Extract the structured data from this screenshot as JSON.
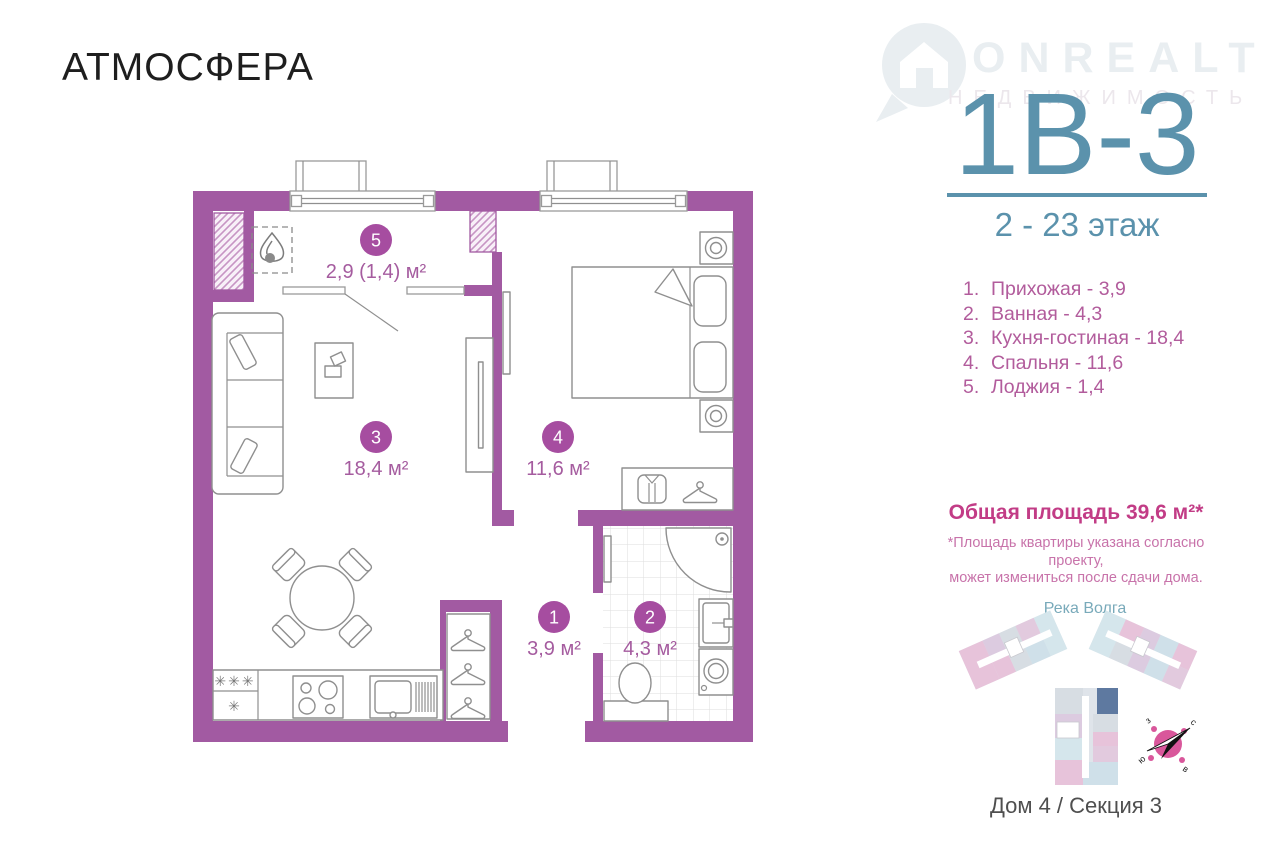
{
  "theme": {
    "wall_purple": "#a25aa2",
    "room_circle": "#a64da0",
    "plan_label": "#a55c9f",
    "accent_teal": "#5b92ac",
    "accent_teal_light": "#79aaba",
    "list_pink": "#b25c9c",
    "total_pink": "#c23c86",
    "note_pink": "#c873aa",
    "furniture_gray": "#8f8f8f",
    "logo_black": "#1e1e1e",
    "caption_gray": "#4f4f4f",
    "watermark_gray": "#e9eef1",
    "highlight_blue": "#5e79a0",
    "compass_pink": "#d9579b"
  },
  "logo": {
    "text": "АТМОСФЕРА"
  },
  "watermark": {
    "brand": "ONREALT",
    "tagline": "НЕДВИЖИМОСТЬ"
  },
  "unit": {
    "code": "1В-3",
    "floors": "2 - 23 этаж"
  },
  "legend": {
    "items": [
      {
        "num": "1.",
        "text": "Прихожая - 3,9"
      },
      {
        "num": "2.",
        "text": "Ванная - 4,3"
      },
      {
        "num": "3.",
        "text": "Кухня-гостиная - 18,4"
      },
      {
        "num": "4.",
        "text": "Спальня - 11,6"
      },
      {
        "num": "5.",
        "text": "Лоджия - 1,4"
      }
    ]
  },
  "total": {
    "title": "Общая площадь 39,6 м²*",
    "note_line1": "*Площадь квартиры указана согласно проекту,",
    "note_line2": "может измениться после сдачи дома."
  },
  "sitemap": {
    "river_label": "Река Волга",
    "caption": "Дом 4 / Секция 3",
    "compass": {
      "west": "з",
      "north": "с",
      "south": "ю",
      "east": "в"
    }
  },
  "plan": {
    "rooms": [
      {
        "num": "5",
        "area_label": "2,9 (1,4) м²"
      },
      {
        "num": "3",
        "area_label": "18,4 м²"
      },
      {
        "num": "4",
        "area_label": "11,6 м²"
      },
      {
        "num": "1",
        "area_label": "3,9 м²"
      },
      {
        "num": "2",
        "area_label": "4,3 м²"
      }
    ],
    "fridge": {
      "freezer_marks": "✳✳✳",
      "fridge_mark": "✳"
    }
  }
}
